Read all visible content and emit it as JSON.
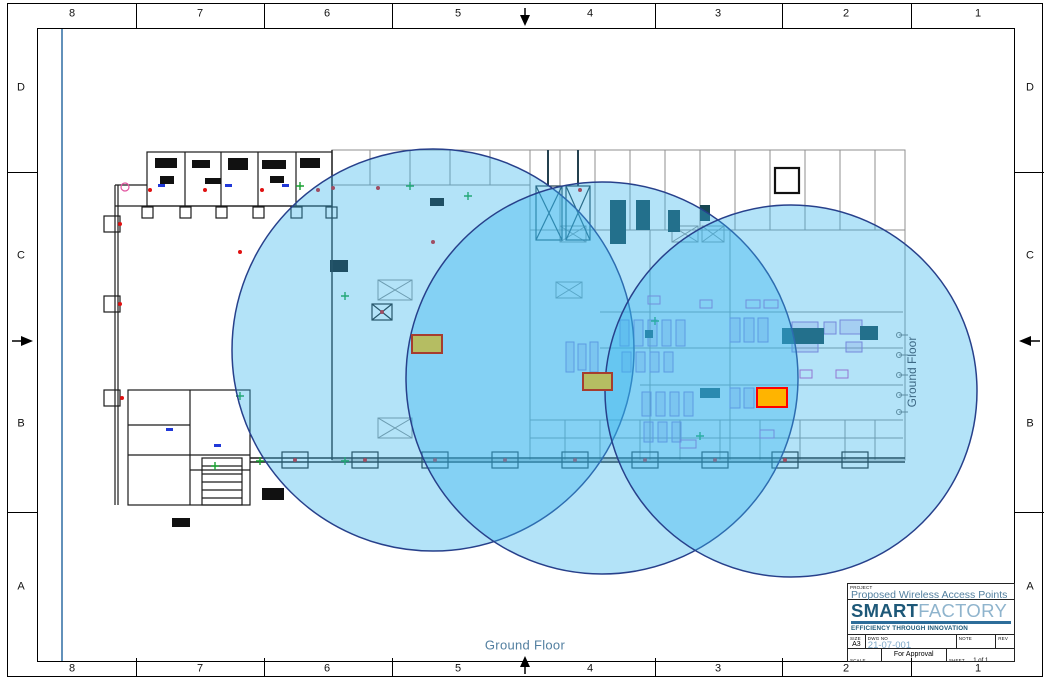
{
  "sheet": {
    "border": {
      "columns": [
        "8",
        "7",
        "6",
        "5",
        "4",
        "3",
        "2",
        "1"
      ],
      "rows": [
        "D",
        "C",
        "B",
        "A"
      ]
    },
    "floor_label": "Ground Floor",
    "floor_label_vertical": "Ground Floor"
  },
  "title_block": {
    "project_label": "PROJECT",
    "project_value": "Proposed Wireless Access Points",
    "logo": {
      "part1": "SMART",
      "part2": "FACTORY",
      "tagline": "EFFICIENCY THROUGH INNOVATION",
      "brand_dark_blue": "#1d5878",
      "brand_light_blue": "#8fb4cd",
      "brand_bar_blue": "#2d6d9a"
    },
    "fields": {
      "size_label": "SIZE",
      "size_value": "A3",
      "dwg_label": "DWG NO",
      "dwg_value": "21-07-001",
      "note_label": "NOTE",
      "note_value": "",
      "rev_label": "REV",
      "rev_value": "",
      "scale_label": "SCALE",
      "scale_value": "NTS",
      "approval_value": "For Approval",
      "sheet_label": "SHEET",
      "sheet_value": "1 of 1"
    }
  },
  "coverage": {
    "fill_color": "rgba(56,182,236,0.38)",
    "stroke_color": "#27408b",
    "circles": [
      {
        "cx": 433,
        "cy": 350,
        "r": 201
      },
      {
        "cx": 602,
        "cy": 378,
        "r": 196
      },
      {
        "cx": 791,
        "cy": 391,
        "r": 186
      }
    ],
    "access_points": [
      {
        "x": 412,
        "y": 335,
        "w": 30,
        "h": 18,
        "fill": "#b5bd62",
        "stroke": "#a63d2f"
      },
      {
        "x": 583,
        "y": 373,
        "w": 29,
        "h": 17,
        "fill": "#b5bd62",
        "stroke": "#a63d2f"
      },
      {
        "x": 757,
        "y": 388,
        "w": 30,
        "h": 19,
        "fill": "#ffb400",
        "stroke": "#ff0000"
      }
    ]
  }
}
